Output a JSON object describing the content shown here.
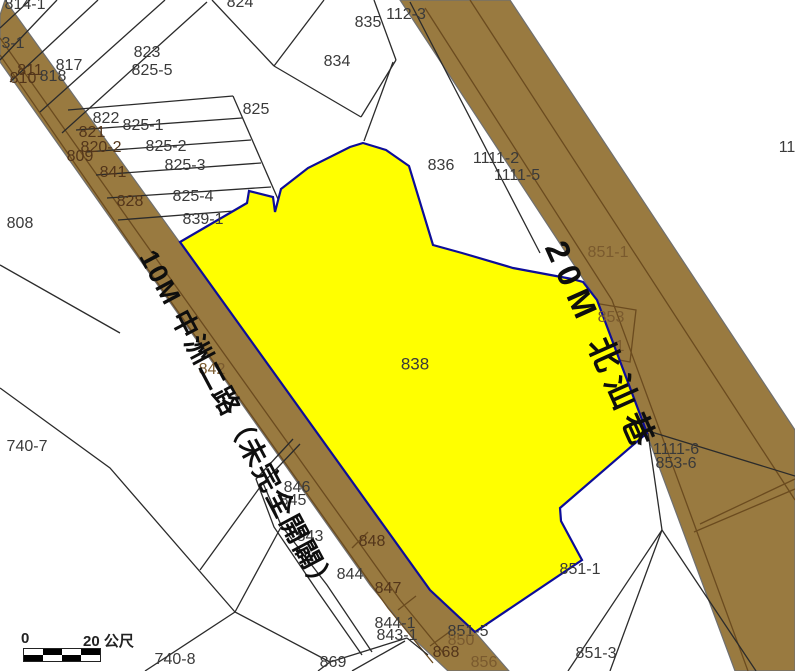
{
  "map": {
    "highlighted_parcel": "838",
    "colors": {
      "road_fill": "#997a40",
      "road_stripe": "#6b4b1f",
      "road_edge": "#6f6f6f",
      "highlight_fill": "#ffff00",
      "highlight_border": "#0d0d99",
      "parcel_line": "#2b2b2b",
      "label_color": "#3a3a3a"
    },
    "road_labels": [
      {
        "text": "10M 中洲二路（未完全開闢）",
        "x": 158,
        "y": 246,
        "rot": 62,
        "size": 27,
        "ls": 2,
        "cls": "road-name",
        "name": "road-label-zhongzhou-2nd-road"
      },
      {
        "text": "20M 北汕巷",
        "x": 570,
        "y": 236,
        "rot": 66,
        "size": 33,
        "ls": 8,
        "cls": "road-name",
        "name": "road-label-beishan-lane"
      }
    ],
    "labels": [
      {
        "text": "814-1",
        "x": 25,
        "y": 5
      },
      {
        "text": "3-1",
        "x": 13,
        "y": 44
      },
      {
        "text": "824",
        "x": 240,
        "y": 3
      },
      {
        "text": "823",
        "x": 147,
        "y": 53
      },
      {
        "text": "825-5",
        "x": 152,
        "y": 71
      },
      {
        "text": "817",
        "x": 69,
        "y": 66
      },
      {
        "text": "811",
        "x": 30,
        "y": 71,
        "cls": "road-dark"
      },
      {
        "text": "818",
        "x": 53,
        "y": 77
      },
      {
        "text": "810",
        "x": 23,
        "y": 79,
        "cls": "road-dark"
      },
      {
        "text": "825",
        "x": 256,
        "y": 110
      },
      {
        "text": "822",
        "x": 106,
        "y": 119
      },
      {
        "text": "825-1",
        "x": 143,
        "y": 126
      },
      {
        "text": "821",
        "x": 92,
        "y": 133,
        "cls": "road-dark"
      },
      {
        "text": "820-2",
        "x": 101,
        "y": 148,
        "cls": "road-dark"
      },
      {
        "text": "825-2",
        "x": 166,
        "y": 147
      },
      {
        "text": "809",
        "x": 80,
        "y": 157,
        "cls": "road-dark"
      },
      {
        "text": "825-3",
        "x": 185,
        "y": 166
      },
      {
        "text": "841",
        "x": 113,
        "y": 173,
        "cls": "road-dark"
      },
      {
        "text": "825-4",
        "x": 193,
        "y": 197
      },
      {
        "text": "828",
        "x": 130,
        "y": 202,
        "cls": "road-dark"
      },
      {
        "text": "839-1",
        "x": 203,
        "y": 220
      },
      {
        "text": "808",
        "x": 20,
        "y": 224
      },
      {
        "text": "834",
        "x": 337,
        "y": 62
      },
      {
        "text": "835",
        "x": 368,
        "y": 23
      },
      {
        "text": "112-3",
        "x": 406,
        "y": 15
      },
      {
        "text": "836",
        "x": 441,
        "y": 166
      },
      {
        "text": "1111-2",
        "x": 496,
        "y": 159
      },
      {
        "text": "1111-5",
        "x": 517,
        "y": 176
      },
      {
        "text": "11",
        "x": 787,
        "y": 148
      },
      {
        "text": "838",
        "x": 415,
        "y": 364,
        "size": 17,
        "name": "highlighted-parcel-label"
      },
      {
        "text": "842",
        "x": 212,
        "y": 370,
        "cls": "road-faint"
      },
      {
        "text": "740-7",
        "x": 27,
        "y": 447
      },
      {
        "text": "851-1",
        "x": 608,
        "y": 253,
        "cls": "road-faint"
      },
      {
        "text": "853",
        "x": 611,
        "y": 318,
        "cls": "road-faint"
      },
      {
        "text": "1",
        "x": 620,
        "y": 347,
        "cls": "road-faint"
      },
      {
        "text": "1111-6",
        "x": 676,
        "y": 450
      },
      {
        "text": "853-6",
        "x": 676,
        "y": 464
      },
      {
        "text": "846",
        "x": 297,
        "y": 488
      },
      {
        "text": "845",
        "x": 293,
        "y": 501
      },
      {
        "text": "843",
        "x": 310,
        "y": 537
      },
      {
        "text": "848",
        "x": 372,
        "y": 542,
        "cls": "road-dark"
      },
      {
        "text": "844",
        "x": 350,
        "y": 575
      },
      {
        "text": "847",
        "x": 388,
        "y": 589,
        "cls": "road-dark"
      },
      {
        "text": "851-1",
        "x": 580,
        "y": 570
      },
      {
        "text": "844-1",
        "x": 395,
        "y": 624
      },
      {
        "text": "843-1",
        "x": 397,
        "y": 636
      },
      {
        "text": "851-5",
        "x": 468,
        "y": 632
      },
      {
        "text": "850",
        "x": 461,
        "y": 641,
        "cls": "road-faint"
      },
      {
        "text": "868",
        "x": 446,
        "y": 653,
        "cls": "road-dark"
      },
      {
        "text": "856",
        "x": 484,
        "y": 663,
        "cls": "road-faint"
      },
      {
        "text": "869",
        "x": 333,
        "y": 663
      },
      {
        "text": "851-3",
        "x": 596,
        "y": 654
      },
      {
        "text": "740-8",
        "x": 175,
        "y": 660
      }
    ],
    "scale_bar": {
      "zero": "0",
      "end": "20 公尺"
    }
  }
}
